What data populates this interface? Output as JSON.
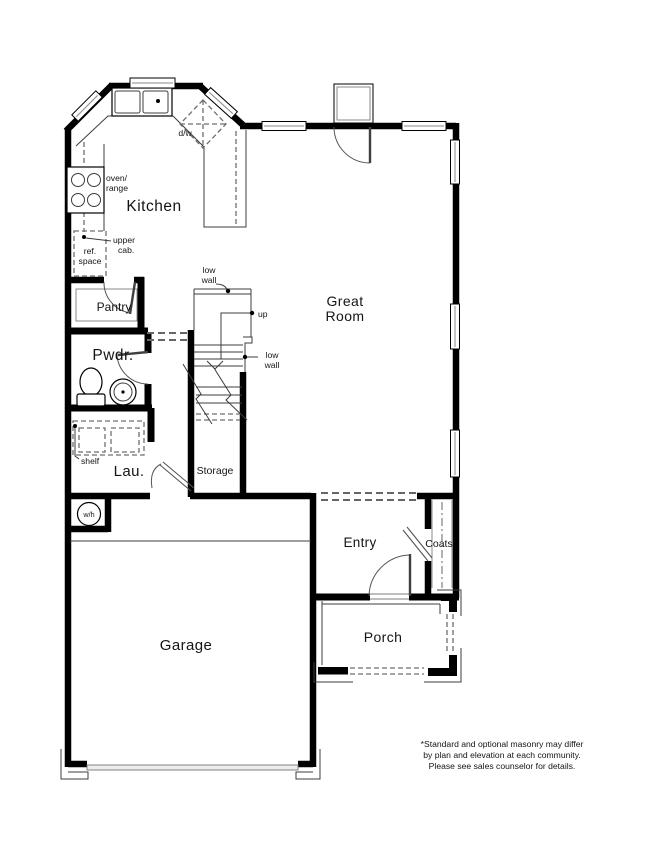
{
  "rooms": {
    "kitchen": "Kitchen",
    "great_room_l1": "Great",
    "great_room_l2": "Room",
    "pantry": "Pantry",
    "powder": "Pwdr.",
    "laundry": "Lau.",
    "storage": "Storage",
    "garage": "Garage",
    "entry": "Entry",
    "coats": "Coats",
    "porch": "Porch"
  },
  "labels": {
    "dishwasher": "d/w",
    "oven_l1": "oven/",
    "oven_l2": "range",
    "upper_cab_l1": "upper",
    "upper_cab_l2": "cab.",
    "ref_l1": "ref.",
    "ref_l2": "space",
    "low_wall_l1": "low",
    "low_wall_l2": "wall",
    "up": "up",
    "shelf": "shelf",
    "water_heater": "w/h"
  },
  "disclaimer": {
    "l1": "*Standard and optional masonry may differ",
    "l2": "by plan and elevation at each community.",
    "l3": "Please see sales counselor for details."
  },
  "colors": {
    "wall": "#000000",
    "thin_line": "#3c3c3c",
    "dashed_line": "#6f6f6f",
    "background": "#ffffff",
    "text": "#141414"
  }
}
